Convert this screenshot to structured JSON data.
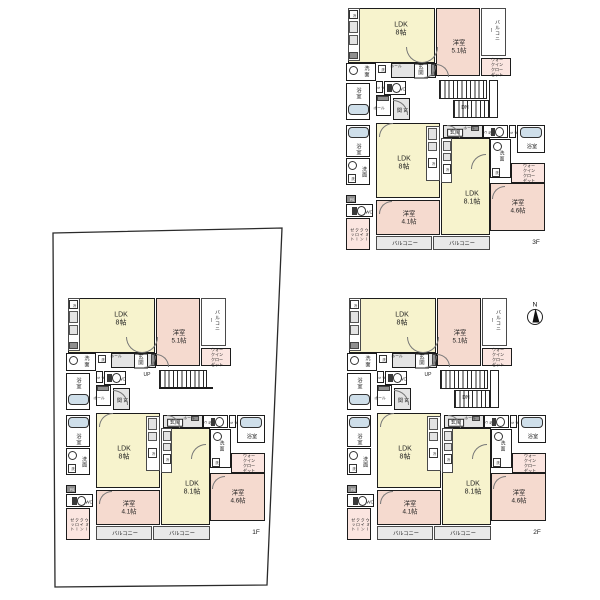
{
  "meta": {
    "background": "#ffffff",
    "description_labels_language": "ja"
  },
  "colors": {
    "wall": "#1c1c1c",
    "ldk": "#f7f3cd",
    "bedroom": "#f5dacf",
    "wic": "#fbe5e0",
    "balcony": "#e9e9e9",
    "entry": "#e4e4e4",
    "fixture": "#cfdfea",
    "white": "#ffffff",
    "dark": "#8f8f8f",
    "kcounter": "#e3e3e3"
  },
  "labels": {
    "ldk8": [
      "LDK",
      "8帖"
    ],
    "ldk81": [
      "LDK",
      "8.1帖"
    ],
    "yo51": [
      "洋室",
      "5.1帖"
    ],
    "yo41": [
      "洋室",
      "4.1帖"
    ],
    "yo46": [
      "洋室",
      "4.6帖"
    ],
    "balcony": "バルコニー",
    "wic": [
      "ウォークイン",
      "クローゼット"
    ],
    "wic_v": [
      "ウォークイン",
      "クローゼット"
    ],
    "senmen": "洗面",
    "sen": "洗",
    "bath": "浴室",
    "wc": "WC",
    "wc_v": [
      "W",
      "C"
    ],
    "ps": [
      "P",
      "S"
    ],
    "ps_box": "PS",
    "hall": "ホール",
    "genkan": "玄関",
    "genkan_v": "玄関",
    "rei": "冷",
    "up": "UP",
    "dn": "DN",
    "north": "N",
    "floor1": "1F",
    "floor2": "2F",
    "floor3": "3F"
  },
  "floors": [
    {
      "id": "3f",
      "label_key": "floor3",
      "x": 343,
      "y": 8,
      "stairs": "down",
      "north_arrow": false
    },
    {
      "id": "2f",
      "label_key": "floor2",
      "x": 344,
      "y": 298,
      "stairs": "both",
      "north_arrow": true
    },
    {
      "id": "1f",
      "label_key": "floor1",
      "x": 63,
      "y": 298,
      "stairs": "up",
      "north_arrow": false
    }
  ],
  "site_boundary": {
    "floor": "1f",
    "points": [
      [
        53,
        233
      ],
      [
        282,
        228
      ],
      [
        267,
        585
      ],
      [
        55,
        587
      ]
    ],
    "stroke": "#2a2a2a"
  },
  "north_arrow": {
    "x": 535,
    "y": 317,
    "r": 7.5,
    "label_key": "north"
  },
  "template": {
    "size": {
      "w": 205,
      "h": 248
    },
    "rooms": [
      {
        "n": "ldk-a",
        "x": 5,
        "y": 0,
        "w": 87,
        "h": 55,
        "f": "ldk",
        "lab": "ldk8",
        "fs": 7,
        "lx": 52,
        "ly": 21
      },
      {
        "n": "yoshitsu-51",
        "x": 93,
        "y": 0,
        "w": 44,
        "h": 68,
        "f": "bedroom",
        "lab": "yo51",
        "fs": 6.3,
        "lx": 22,
        "ly": 38
      },
      {
        "n": "balcony-a",
        "x": 138,
        "y": 0,
        "w": 25,
        "h": 48,
        "f": "white",
        "lab": "balcony",
        "fs": 5,
        "vert": true,
        "thin": true,
        "lx": 12,
        "ly": 21
      },
      {
        "n": "wic-a",
        "x": 138,
        "y": 50,
        "w": 30,
        "h": 18,
        "f": "wic",
        "lab": "wic",
        "fs": 4.1,
        "lx": 15,
        "ly": 9
      },
      {
        "n": "entry-a",
        "x": 48,
        "y": 55,
        "w": 45,
        "h": 15,
        "f": "entry",
        "lab": "genkan",
        "fs": 5.4,
        "boxed": true,
        "lx": 29,
        "ly": 7
      },
      {
        "n": "senmen-a",
        "x": 3,
        "y": 55,
        "w": 30,
        "h": 18,
        "f": "white",
        "lab": "senmen",
        "fs": 5.2,
        "lx": 20,
        "ly": 8
      },
      {
        "n": "ps-a",
        "x": 33,
        "y": 73,
        "w": 7,
        "h": 12,
        "f": "white",
        "lab": "ps",
        "fs": 3.4,
        "vert": true,
        "lx": 3.5,
        "ly": 6
      },
      {
        "n": "wc-a",
        "x": 41,
        "y": 73,
        "w": 22,
        "h": 14,
        "f": "white",
        "lab": "wc",
        "fs": 4.4,
        "lx": 17,
        "ly": 7
      },
      {
        "n": "bath-a",
        "x": 3,
        "y": 75,
        "w": 24,
        "h": 37,
        "f": "white",
        "lab": "bath",
        "fs": 5.2,
        "lx": 12,
        "ly": 10
      },
      {
        "n": "hall-b",
        "x": 33,
        "y": 87,
        "w": 15,
        "h": 21,
        "f": "white"
      },
      {
        "n": "genkan-b",
        "x": 50,
        "y": 90,
        "w": 17,
        "h": 22,
        "f": "entry",
        "lab": "genkan_v",
        "fs": 5.2,
        "vert": true,
        "lx": 8,
        "ly": 11
      },
      {
        "n": "bath-b",
        "x": 3,
        "y": 117,
        "w": 24,
        "h": 32,
        "f": "white",
        "lab": "bath",
        "fs": 5.2,
        "lx": 12,
        "ly": 24
      },
      {
        "n": "ldk-b",
        "x": 33,
        "y": 115,
        "w": 64,
        "h": 75,
        "f": "ldk",
        "lab": "ldk8",
        "fs": 7,
        "lx": 27,
        "ly": 40
      },
      {
        "n": "kitchen-b",
        "x": 83,
        "y": 118,
        "w": 14,
        "h": 55,
        "f": "white",
        "thin": true
      },
      {
        "n": "senmen-b",
        "x": 3,
        "y": 150,
        "w": 24,
        "h": 27,
        "f": "white",
        "lab": "senmen",
        "fs": 5.2,
        "vert": true,
        "lx": 17,
        "ly": 13
      },
      {
        "n": "ps-b",
        "x": 3,
        "y": 187,
        "w": 10,
        "h": 8,
        "f": "dark",
        "lab": "ps_box",
        "fs": 3.4,
        "lx": 5,
        "ly": 4,
        "lc": "#ffffff"
      },
      {
        "n": "wc-b",
        "x": 3,
        "y": 196,
        "w": 27,
        "h": 13,
        "f": "white",
        "lab": "wc",
        "fs": 4.4,
        "lx": 22,
        "ly": 6.5
      },
      {
        "n": "wic-b",
        "x": 3,
        "y": 210,
        "w": 24,
        "h": 32,
        "f": "wic",
        "lab": "wic_v",
        "fs": 4,
        "vert": true,
        "lx": 12,
        "ly": 16
      },
      {
        "n": "yoshitsu-41",
        "x": 33,
        "y": 192,
        "w": 64,
        "h": 35,
        "f": "bedroom",
        "lab": "yo41",
        "fs": 6.3,
        "lx": 32,
        "ly": 17
      },
      {
        "n": "balcony-b",
        "x": 33,
        "y": 228,
        "w": 56,
        "h": 14,
        "f": "balcony",
        "lab": "balcony",
        "fs": 5.2,
        "thin": true,
        "lx": 28,
        "ly": 7
      },
      {
        "n": "entry-c",
        "x": 100,
        "y": 117,
        "w": 40,
        "h": 13,
        "f": "entry",
        "lab": "genkan",
        "fs": 5.4,
        "boxed": true,
        "lx": 11,
        "ly": 6.5
      },
      {
        "n": "wc-c",
        "x": 140,
        "y": 117,
        "w": 25,
        "h": 13,
        "f": "white",
        "lab": "wc_v",
        "fs": 3.4,
        "vert": true,
        "lx": 3.5,
        "ly": 6.5
      },
      {
        "n": "ps-c",
        "x": 166,
        "y": 117,
        "w": 7,
        "h": 13,
        "f": "white",
        "lab": "ps",
        "fs": 3.4,
        "vert": true,
        "lx": 3.5,
        "ly": 6.5
      },
      {
        "n": "bath-c",
        "x": 174,
        "y": 117,
        "w": 28,
        "h": 28,
        "f": "white",
        "lab": "bath",
        "fs": 5.2,
        "lx": 14,
        "ly": 21
      },
      {
        "n": "senmen-c",
        "x": 147,
        "y": 131,
        "w": 21,
        "h": 39,
        "f": "white",
        "lab": "senmen",
        "fs": 4.8,
        "lx": 11,
        "ly": 17
      },
      {
        "n": "wic-c",
        "x": 168,
        "y": 155,
        "w": 34,
        "h": 20,
        "f": "wic",
        "lab": "wic",
        "fs": 4.1,
        "lx": 17,
        "ly": 10
      },
      {
        "n": "ldk-c",
        "x": 98,
        "y": 130,
        "w": 49,
        "h": 97,
        "f": "ldk",
        "lab": "ldk81",
        "fs": 7,
        "lx": 30,
        "ly": 60
      },
      {
        "n": "kitchen-c",
        "x": 98,
        "y": 130,
        "w": 11,
        "h": 45,
        "f": "white",
        "thin": true
      },
      {
        "n": "yoshitsu-46",
        "x": 147,
        "y": 175,
        "w": 55,
        "h": 48,
        "f": "bedroom",
        "lab": "yo46",
        "fs": 6.3,
        "lx": 27,
        "ly": 23
      },
      {
        "n": "balcony-c",
        "x": 90,
        "y": 228,
        "w": 57,
        "h": 14,
        "f": "balcony",
        "lab": "balcony",
        "fs": 5.2,
        "thin": true,
        "lx": 28,
        "ly": 7
      },
      {
        "n": "kitchen-a",
        "x": 5,
        "y": 0,
        "w": 12,
        "h": 53,
        "f": "white",
        "thin": true
      }
    ],
    "icons": [
      {
        "t": "fridge",
        "x": 6,
        "y": 2,
        "w": 9,
        "h": 9
      },
      {
        "t": "kbox",
        "x": 6,
        "y": 13,
        "w": 9,
        "h": 12
      },
      {
        "t": "kbox",
        "x": 6,
        "y": 27,
        "w": 9,
        "h": 10
      },
      {
        "t": "dark",
        "x": 6,
        "y": 44,
        "w": 9,
        "h": 7
      },
      {
        "t": "washer",
        "x": 35,
        "y": 56.5,
        "w": 8,
        "h": 8.5
      },
      {
        "t": "sinkc",
        "x": 6,
        "y": 58,
        "w": 9,
        "h": 9
      },
      {
        "t": "toilet",
        "x": 44,
        "y": 75,
        "w": 15,
        "h": 10
      },
      {
        "t": "tub",
        "x": 4.5,
        "y": 96,
        "w": 21,
        "h": 11
      },
      {
        "t": "dark",
        "x": 34,
        "y": 88,
        "w": 12,
        "h": 5
      },
      {
        "t": "dark",
        "x": 88,
        "y": 56,
        "w": 4,
        "h": 12
      },
      {
        "t": "tub",
        "x": 4.5,
        "y": 119,
        "w": 21,
        "h": 11
      },
      {
        "t": "sinkc",
        "x": 5,
        "y": 153,
        "w": 9,
        "h": 9
      },
      {
        "t": "washer",
        "x": 5,
        "y": 166,
        "w": 8,
        "h": 8.5
      },
      {
        "t": "toilet",
        "x": 9,
        "y": 197.5,
        "w": 15,
        "h": 10
      },
      {
        "t": "kbox",
        "x": 85,
        "y": 120,
        "w": 9,
        "h": 12
      },
      {
        "t": "kbox",
        "x": 85,
        "y": 134,
        "w": 9,
        "h": 9
      },
      {
        "t": "fridge",
        "x": 85,
        "y": 150,
        "w": 9,
        "h": 10
      },
      {
        "t": "toilet",
        "x": 148,
        "y": 118.5,
        "w": 14,
        "h": 10
      },
      {
        "t": "sinkc",
        "x": 150,
        "y": 133.5,
        "w": 9,
        "h": 9
      },
      {
        "t": "washer",
        "x": 149,
        "y": 160,
        "w": 8,
        "h": 8.5
      },
      {
        "t": "tub",
        "x": 177,
        "y": 119,
        "w": 22,
        "h": 11
      },
      {
        "t": "kbox",
        "x": 99.5,
        "y": 133,
        "w": 8,
        "h": 10
      },
      {
        "t": "kbox",
        "x": 99.5,
        "y": 145,
        "w": 8,
        "h": 8
      },
      {
        "t": "fridge",
        "x": 99.5,
        "y": 156,
        "w": 8,
        "h": 10
      },
      {
        "t": "dark",
        "x": 128,
        "y": 118,
        "w": 8,
        "h": 5
      }
    ],
    "texts": [
      {
        "x": 53,
        "y": 58.5,
        "lab": "hall",
        "fs": 3.8
      },
      {
        "x": 36,
        "y": 101,
        "lab": "hall",
        "fs": 3.8
      },
      {
        "x": 126,
        "y": 121,
        "lab": "hall",
        "fs": 3.8
      }
    ],
    "arcs": [
      {
        "x": 63,
        "y": 39,
        "r": 16,
        "c": "bl"
      },
      {
        "x": 79,
        "y": 39,
        "r": 16,
        "c": "br"
      },
      {
        "x": 93,
        "y": 56,
        "r": 13,
        "c": "tr"
      },
      {
        "x": 81,
        "y": 58,
        "r": 12,
        "c": "br"
      },
      {
        "x": 50,
        "y": 92,
        "r": 15,
        "c": "tr"
      },
      {
        "x": 36,
        "y": 115,
        "r": 14,
        "c": "tl"
      },
      {
        "x": 104,
        "y": 117,
        "r": 13,
        "c": "tr"
      },
      {
        "x": 128,
        "y": 146,
        "r": 15,
        "c": "tl"
      },
      {
        "x": 36,
        "y": 193,
        "r": 13,
        "c": "tl"
      },
      {
        "x": 149,
        "y": 178,
        "r": 13,
        "c": "tl"
      }
    ],
    "stairs": {
      "well": {
        "x": 94,
        "y": 70,
        "w": 58,
        "h": 47
      },
      "run1": {
        "x": 96,
        "y": 72,
        "w": 48,
        "h": 19
      },
      "run2": {
        "x": 110,
        "y": 92,
        "w": 36,
        "h": 18
      },
      "landing": {
        "x": 146,
        "y": 72,
        "w": 9,
        "h": 38
      },
      "landline": {
        "x": 96,
        "y": 89,
        "w": 54,
        "h": 2
      },
      "up_pos": [
        84,
        77
      ],
      "dn_pos": [
        122,
        100
      ]
    },
    "floor_label": {
      "x": 183,
      "y": 231,
      "w": 20,
      "fs": 6.5
    }
  }
}
